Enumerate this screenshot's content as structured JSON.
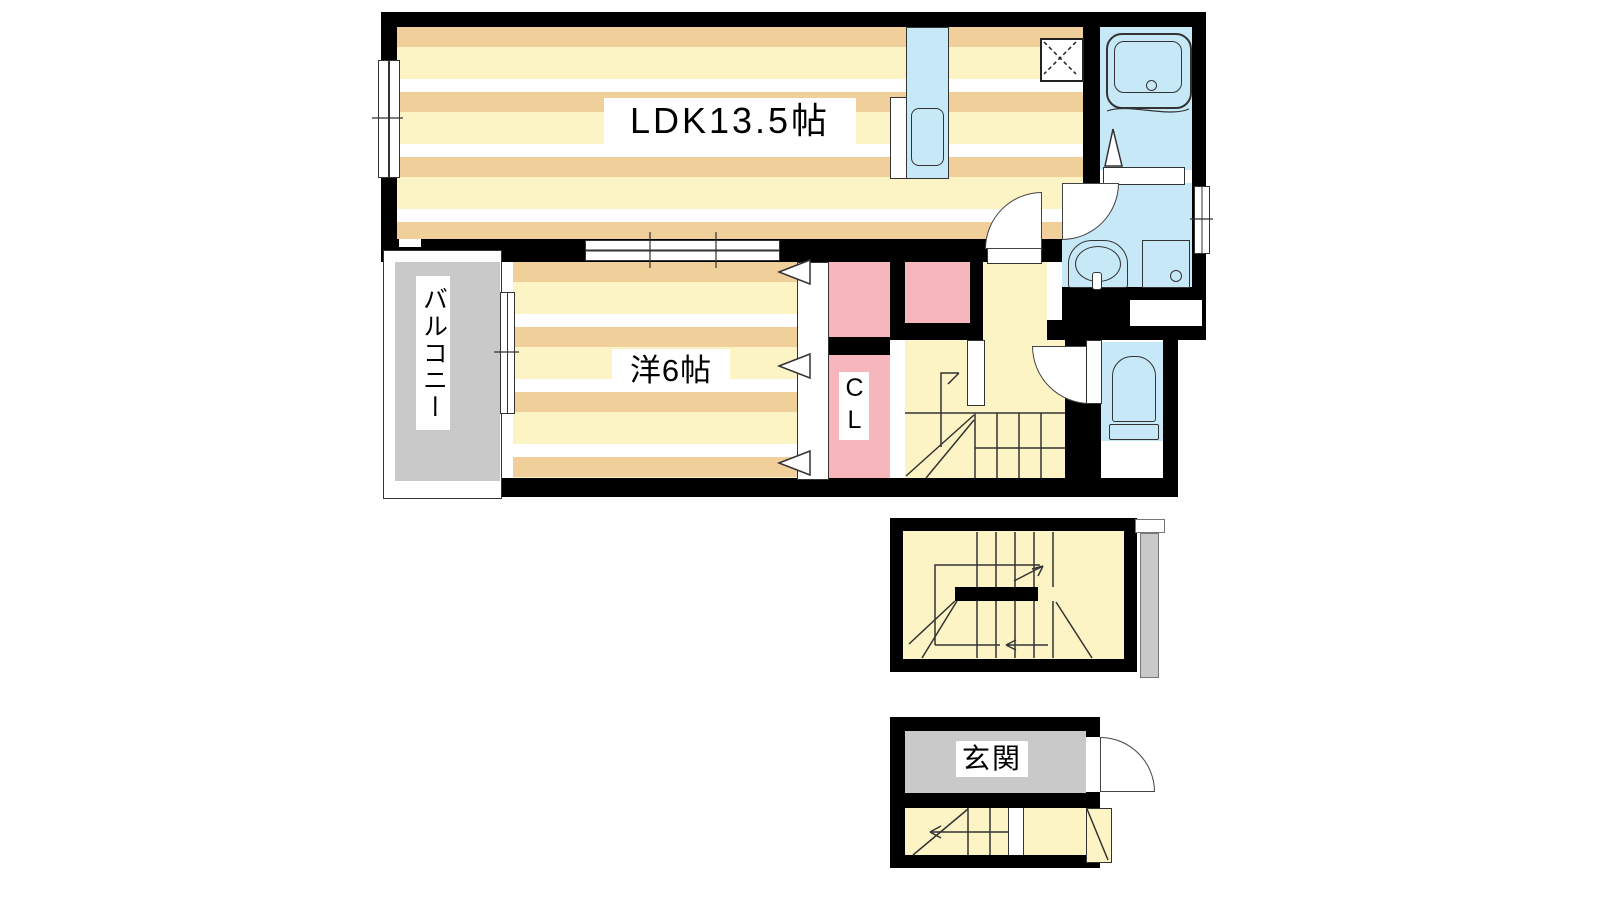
{
  "plan": {
    "type": "japanese-apartment-floor-plan",
    "rooms": {
      "ldk": {
        "label": "LDK13.5帖"
      },
      "western_room": {
        "label": "洋6帖"
      },
      "closet": {
        "label": "CL"
      },
      "balcony": {
        "label": "バルコニー"
      },
      "entrance": {
        "label": "玄関"
      }
    },
    "colors": {
      "wall": "#000000",
      "floor_stripe_yellow": "#FCF4C4",
      "floor_stripe_tan": "#F1CF9B",
      "floor_stripe_white": "#FFFFFF",
      "hall_stairs_yellow": "#FCF4C4",
      "water_area_blue": "#C7E8F7",
      "closet_pink": "#F7B6BB",
      "balcony_gray": "#C9C9C9",
      "outline": "#333333"
    },
    "fixtures": {
      "kitchen": "kitchen-counter-with-sink",
      "stove": "gas-stove",
      "bath": "bathtub",
      "washroom": "washbasin-and-washer-pan",
      "toilet": "toilet",
      "stairs_upper": "staircase-up",
      "stairs_landing": "u-shaped-staircase",
      "entrance_steps": "entrance-steps"
    }
  }
}
